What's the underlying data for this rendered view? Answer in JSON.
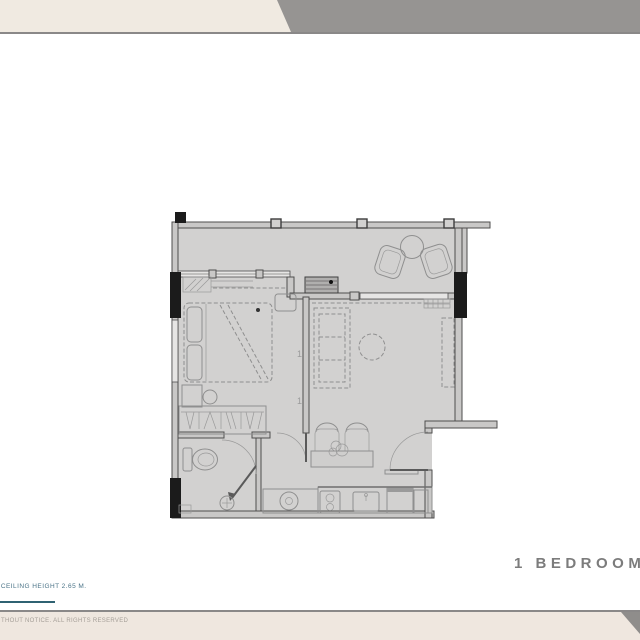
{
  "document": {
    "title": "1 BEDROOM",
    "ceiling_note": "- CEILING HEIGHT 2.65 M.",
    "rights_note": "THOUT NOTICE. ALL RIGHTS RESERVED"
  },
  "floor_plan": {
    "type": "one-bedroom-unit-plan",
    "door_tag_upper": "1",
    "door_tag_lower": "1",
    "rooms_depicted": [
      "balcony",
      "bedroom",
      "wardrobe",
      "bathroom",
      "living-dining",
      "kitchen",
      "entry"
    ]
  },
  "colors": {
    "banner_cream": "#f0eae1",
    "banner_gray": "#969492",
    "divider_gray": "#8a8888",
    "accent_teal": "#2f6272",
    "note_teal": "#4a7387",
    "floor_fill": "#d2d1d0",
    "wall_stroke": "#4e4e4e",
    "furniture_stroke": "#8f8f8f",
    "title_gray": "#7c7c7c"
  }
}
